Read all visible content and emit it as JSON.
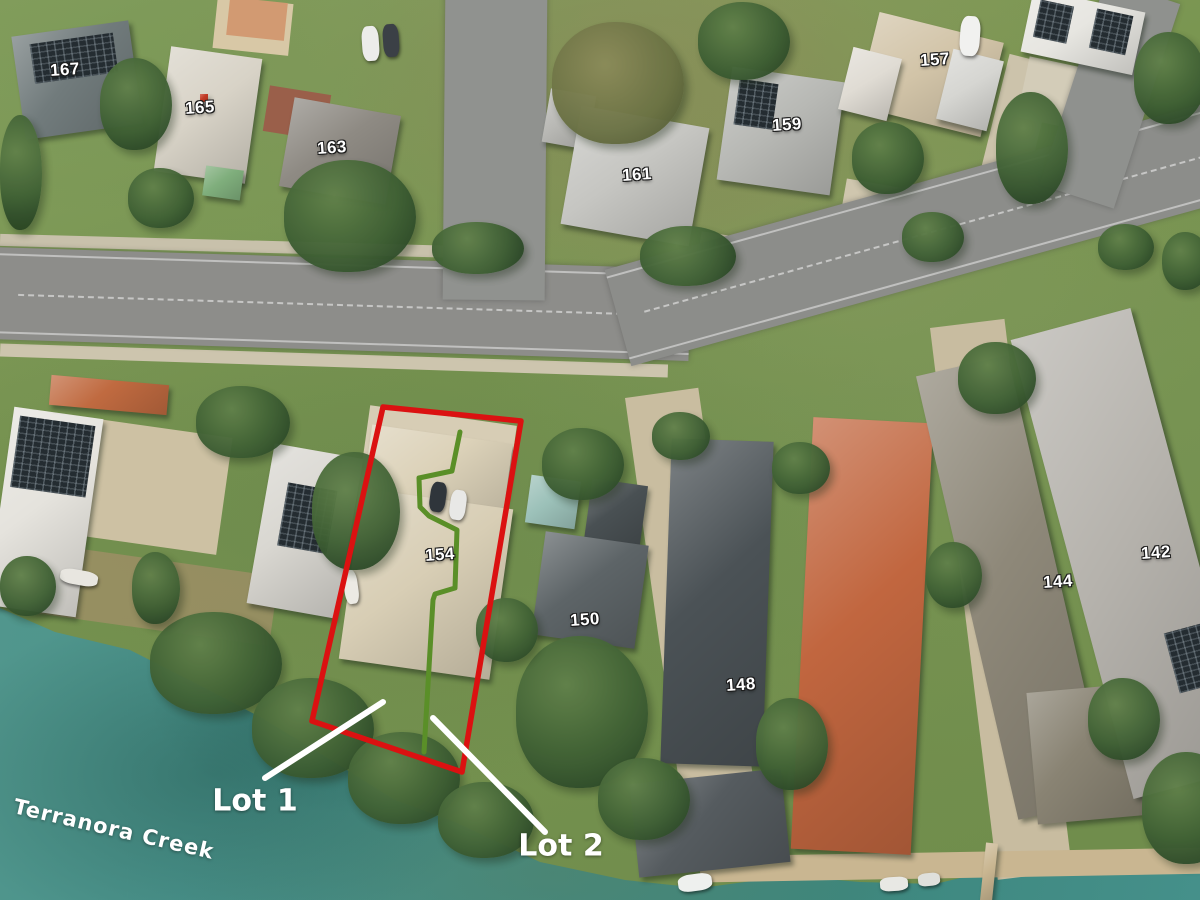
{
  "map": {
    "description": "Aerial photo of waterfront residential subdivision",
    "creek_label": {
      "text": "Terranora Creek",
      "x": 14,
      "y": 806,
      "rotation_deg": 13
    },
    "lot_labels": [
      {
        "text": "Lot 1",
        "x": 255,
        "y": 801
      },
      {
        "text": "Lot 2",
        "x": 561,
        "y": 846
      }
    ],
    "house_numbers": [
      {
        "text": "167",
        "x": 65,
        "y": 70
      },
      {
        "text": "165",
        "x": 200,
        "y": 108
      },
      {
        "text": "163",
        "x": 332,
        "y": 148
      },
      {
        "text": "161",
        "x": 637,
        "y": 175
      },
      {
        "text": "159",
        "x": 787,
        "y": 125
      },
      {
        "text": "157",
        "x": 935,
        "y": 60
      },
      {
        "text": "154",
        "x": 440,
        "y": 555
      },
      {
        "text": "150",
        "x": 585,
        "y": 620
      },
      {
        "text": "148",
        "x": 741,
        "y": 685
      },
      {
        "text": "144",
        "x": 1058,
        "y": 582
      },
      {
        "text": "142",
        "x": 1156,
        "y": 553
      }
    ],
    "annotations": {
      "boundary_color": "#db1111",
      "divider_color": "#5a8f28",
      "leader_color": "#ffffff",
      "water_color": "#45908a",
      "boundary_points": [
        [
          383,
          407
        ],
        [
          521,
          421
        ],
        [
          462,
          772
        ],
        [
          312,
          721
        ]
      ],
      "divider_points": [
        [
          460,
          432
        ],
        [
          452,
          471
        ],
        [
          419,
          478
        ],
        [
          420,
          507
        ],
        [
          429,
          516
        ],
        [
          457,
          530
        ],
        [
          455,
          588
        ],
        [
          435,
          594
        ],
        [
          433,
          600
        ],
        [
          424,
          752
        ]
      ],
      "leader_lines": [
        {
          "x1": 383,
          "y1": 702,
          "x2": 265,
          "y2": 778
        },
        {
          "x1": 433,
          "y1": 718,
          "x2": 545,
          "y2": 832
        }
      ]
    }
  }
}
